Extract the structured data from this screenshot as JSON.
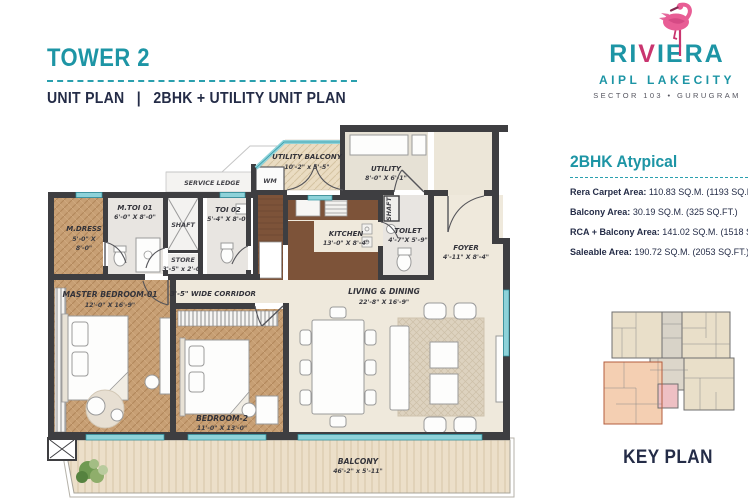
{
  "header": {
    "tower": "TOWER 2",
    "subtitle_left": "UNIT PLAN",
    "subtitle_sep": "|",
    "subtitle_right": "2BHK + UTILITY UNIT PLAN"
  },
  "logo": {
    "brand_pre": "RI",
    "brand_v": "V",
    "brand_post": "IERA",
    "name": "AIPL LAKECITY",
    "tagline": "SECTOR 103 • GURUGRAM"
  },
  "specs": {
    "heading": "2BHK Atypical",
    "items": [
      {
        "label": "Rera Carpet Area:",
        "value": "110.83 SQ.M. (1193 SQ.FT.)"
      },
      {
        "label": "Balcony Area:",
        "value": "30.19 SQ.M. (325 SQ.FT.)"
      },
      {
        "label": "RCA + Balcony Area:",
        "value": "141.02 SQ.M. (1518 SQ.FT.)"
      },
      {
        "label": "Saleable Area:",
        "value": "190.72 SQ.M. (2053 SQ.FT.)"
      }
    ]
  },
  "keyplan": {
    "label": "KEY PLAN"
  },
  "colors": {
    "teal": "#1d95a5",
    "navy": "#242c47",
    "flamingo_pink": "#e85d95",
    "flamingo_dark_pink": "#c9356f",
    "wall": "#3e3e41",
    "window_glass": "#8ed2d9",
    "wood_floor": "#c79f74",
    "keyplan_highlight": "#f4cfb2"
  },
  "plan": {
    "rooms": [
      {
        "name": "MASTER BEDROOM-01",
        "dims": "12'-0\" X 16'-9\""
      },
      {
        "name": "BEDROOM-2",
        "dims": "11'-0\" X 13'-0\""
      },
      {
        "name": "LIVING & DINING",
        "dims": "22'-8\" X 16'-9\""
      },
      {
        "name": "KITCHEN",
        "dims": "13'-0\" X 8'-4\""
      },
      {
        "name": "BALCONY",
        "dims": "46'-2\" x 5'-11\""
      },
      {
        "name": "UTILITY BALCONY",
        "dims": "10'-2\" x 5'-5\""
      },
      {
        "name": "UTILITY",
        "dims": "8'-0\" X 6'-1\""
      },
      {
        "name": "FOYER",
        "dims": "4'-11\" X 8'-4\""
      },
      {
        "name": "TOILET",
        "dims": "4'-7\"X 5'-9\""
      },
      {
        "name": "M.TOI 01",
        "dims": "6'-0\" X 8'-0\""
      },
      {
        "name": "TOI 02",
        "dims": "5'-4\" X 8'-0\""
      },
      {
        "name": "M.DRESS",
        "dims1": "5'-0\" X",
        "dims2": "8'-0\""
      },
      {
        "name": "STORE",
        "dims": "3'-5\" x 2'-0\""
      },
      {
        "name": "3'-5\" WIDE CORRIDOR"
      },
      {
        "name": "SERVICE LEDGE"
      },
      {
        "name": "SHAFT"
      },
      {
        "name": "SHAFT"
      },
      {
        "name": "WM"
      }
    ]
  }
}
